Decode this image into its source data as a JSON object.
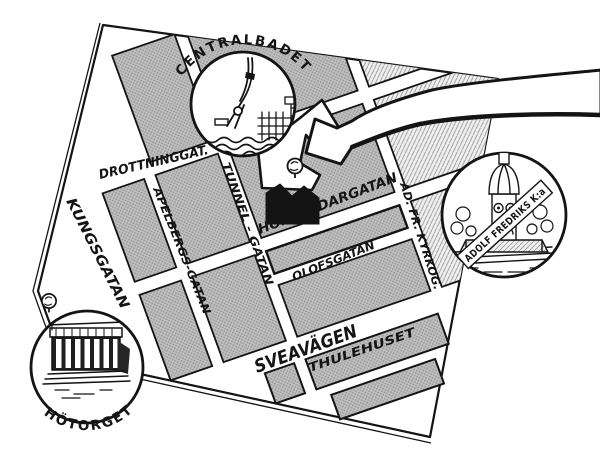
{
  "map": {
    "marker": {
      "label": "9A"
    },
    "streets": {
      "drottninggatan": "DROTTNINGGAT.",
      "kungsgatan": "KUNGSGATAN",
      "apelbergsgatan": "APELBERGS-GATAN",
      "tunnelgatan": "TUNNEL - GATAN",
      "hollandargatan": "HOLLÄNDARGATAN",
      "olofsgatan": "OLOFSGATAN",
      "adfrkyrkogatan": "AD. FR. KYRKOG.",
      "sveavagen": "SVEAVÄGEN"
    },
    "buildings": {
      "thulehuset": "THULEHUSET"
    },
    "landmarks": {
      "centralbadet": {
        "label": "CENTRALBADET",
        "icon": "diver-icon"
      },
      "adolf_fredriks": {
        "label": "ADOLF FREDRIKS K:a",
        "icon": "church-icon"
      },
      "hotorget": {
        "label": "HÖTORGET",
        "icon": "market-hall-icon"
      }
    },
    "colors": {
      "paper": "#ffffff",
      "ink": "#141414",
      "block_gray": "#bfbfbf",
      "block_dot": "#9a9a9a",
      "hatch_bg": "#f0f0f0"
    }
  }
}
